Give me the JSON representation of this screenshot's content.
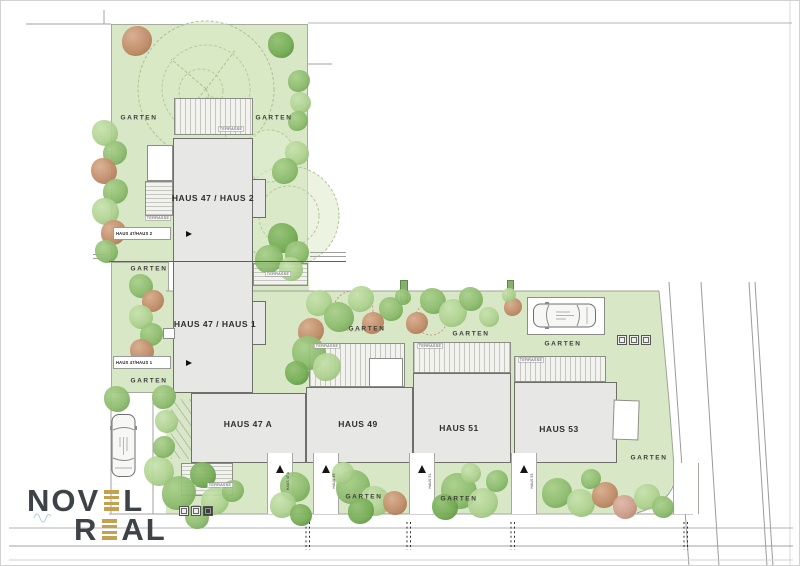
{
  "plan": {
    "houses": [
      {
        "label": "HAUS 47 / HAUS 2"
      },
      {
        "label": "HAUS 47 / HAUS 1"
      },
      {
        "label": "HAUS 47 A"
      },
      {
        "label": "HAUS 49"
      },
      {
        "label": "HAUS 51"
      },
      {
        "label": "HAUS 53"
      }
    ],
    "labels": {
      "garten": "GARTEN",
      "terrasse": "TERRASSE"
    },
    "entrance_signs": [
      {
        "label": "HAUS 47/HAUS 2"
      },
      {
        "label": "HAUS 47/HAUS 1"
      }
    ],
    "entrance_markers": [
      {
        "label": "HAUS 47 A"
      },
      {
        "label": "HAUS 49"
      },
      {
        "label": "HAUS 51"
      },
      {
        "label": "HAUS 53"
      }
    ]
  },
  "logo": {
    "word1_pre": "NOV",
    "word1_post": "L",
    "word2_pre": "R",
    "word2_post": "AL",
    "accent_color": "#c6a04f",
    "text_color": "#3e4347"
  },
  "colors": {
    "garden_green": "#d8e8c7",
    "house_gray": "#e7e7e5",
    "boundary_red": "#b23b32"
  }
}
